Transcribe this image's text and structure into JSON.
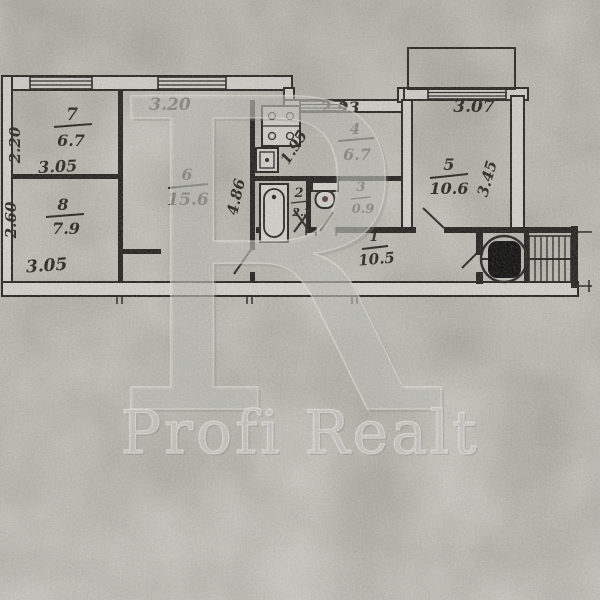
{
  "watermark": {
    "initial": "R",
    "brand": "Profi Realt"
  },
  "rooms": {
    "r7": {
      "number": "7",
      "area": "6.7"
    },
    "r8": {
      "number": "8",
      "area": "7.9"
    },
    "r6": {
      "number": "6",
      "area": "15.6"
    },
    "r4": {
      "number": "4",
      "area": "6.7"
    },
    "r2": {
      "number": "2",
      "area": "2.3"
    },
    "r3": {
      "number": "3",
      "area": "0.9"
    },
    "r5": {
      "number": "5",
      "area": "10.6"
    },
    "r1": {
      "number": "1",
      "area": "10.5"
    }
  },
  "dimensions": {
    "r7_width": "3.05",
    "r7_height": "2.20",
    "r8_width": "3.05",
    "r8_height": "2.60",
    "r6_width": "3.20",
    "r6_height": "4.86",
    "r4_width": "2.93",
    "r4_inner": "1.95",
    "r5_width": "3.07",
    "r5_height": "3.45"
  },
  "palette": {
    "paper": "#d2d1cb",
    "ink": "#21201c",
    "watermark": "#c8c7c2"
  }
}
